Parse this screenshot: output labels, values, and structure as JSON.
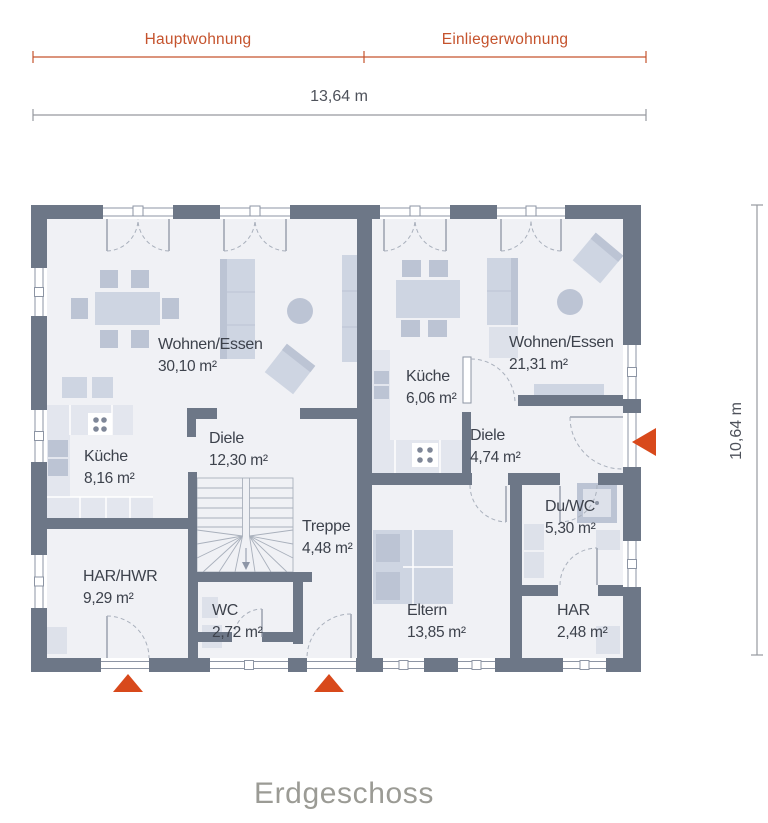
{
  "annotations": {
    "units": [
      {
        "id": "hauptwohnung",
        "label": "Hauptwohnung"
      },
      {
        "id": "einliegerwohnung",
        "label": "Einliegerwohnung"
      }
    ],
    "width_dim": "13,64 m",
    "height_dim": "10,64 m",
    "floor_title": "Erdgeschoss"
  },
  "rooms": {
    "haupt_wohnen": {
      "name": "Wohnen/Essen",
      "area": "30,10 m²"
    },
    "haupt_kueche": {
      "name": "Küche",
      "area": "8,16 m²"
    },
    "haupt_diele": {
      "name": "Diele",
      "area": "12,30 m²"
    },
    "haupt_treppe": {
      "name": "Treppe",
      "area": "4,48 m²"
    },
    "haupt_har_hwr": {
      "name": "HAR/HWR",
      "area": "9,29 m²"
    },
    "haupt_wc": {
      "name": "WC",
      "area": "2,72 m²"
    },
    "einlieger_wohnen": {
      "name": "Wohnen/Essen",
      "area": "21,31 m²"
    },
    "einlieger_kueche": {
      "name": "Küche",
      "area": "6,06 m²"
    },
    "einlieger_diele": {
      "name": "Diele",
      "area": "4,74 m²"
    },
    "einlieger_duwc": {
      "name": "Du/WC",
      "area": "5,30 m²"
    },
    "einlieger_eltern": {
      "name": "Eltern",
      "area": "13,85 m²"
    },
    "einlieger_har": {
      "name": "HAR",
      "area": "2,48 m²"
    }
  },
  "colors": {
    "wall": "#6d7787",
    "floor": "#f0f1f5",
    "accent_orange": "#c5532d",
    "arrow_orange": "#d8491b",
    "dim_text": "#4e525b",
    "title_gray": "#9b9b95"
  }
}
